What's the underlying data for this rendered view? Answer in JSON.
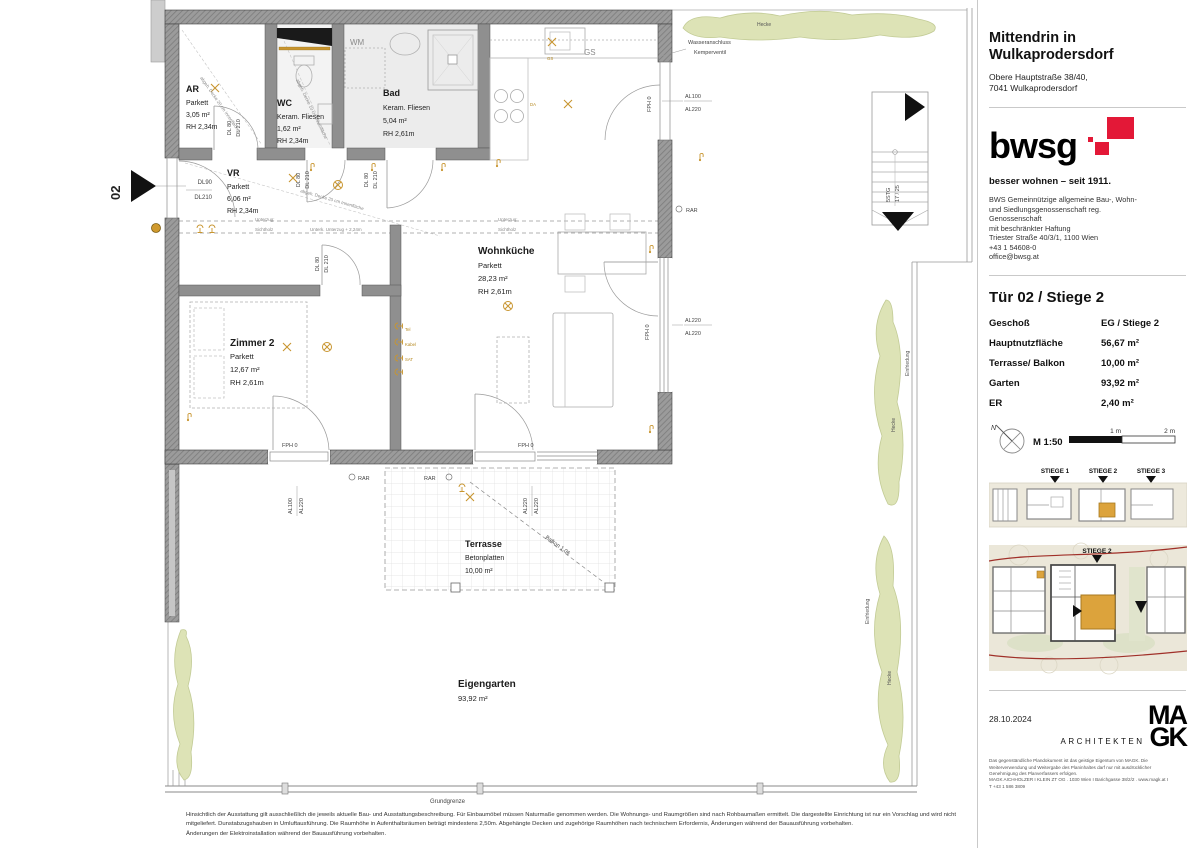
{
  "plan": {
    "rooms": {
      "ar": {
        "name": "AR",
        "mat": "Parkett",
        "area": "3,05 m²",
        "rh": "RH 2,34m"
      },
      "wc": {
        "name": "WC",
        "mat": "Keram. Fliesen",
        "area": "1,62 m²",
        "rh": "RH 2,34m"
      },
      "bad": {
        "name": "Bad",
        "mat": "Keram. Fliesen",
        "area": "5,04 m²",
        "rh": "RH 2,61m"
      },
      "vr": {
        "name": "VR",
        "mat": "Parkett",
        "area": "6,06 m²",
        "rh": "RH 2,34m"
      },
      "wohnkueche": {
        "name": "Wohnküche",
        "mat": "Parkett",
        "area": "28,23 m²",
        "rh": "RH 2,61m"
      },
      "zimmer2": {
        "name": "Zimmer 2",
        "mat": "Parkett",
        "area": "12,67 m²",
        "rh": "RH 2,61m"
      },
      "terrasse": {
        "name": "Terrasse",
        "mat": "Betonplatten",
        "area": "10,00 m²"
      },
      "eigengarten": {
        "name": "Eigengarten",
        "area": "93,92 m²"
      }
    },
    "labels": {
      "unit_number": "02",
      "dl90": "DL90",
      "dl210": "DL210",
      "dl80": "DL 80",
      "dl210s": "DL 210",
      "fph0": "FPH 0",
      "rar": "RAR",
      "al100": "AL100",
      "al220": "AL220",
      "hecke": "Hecke",
      "einfriedung": "Einfriedung",
      "grundgrenze": "Grundgrenze",
      "wm": "WM",
      "gs": "GS",
      "da": "DA",
      "wasseranschluss_l1": "Wasseranschluss",
      "wasseranschluss_l2": "Kemperventil",
      "unterzug_l1": "Unterzug:",
      "unterzug_l2": "Sichtholz",
      "unterzug_beam": "Unterk. Unterzug + 2,24m",
      "balkon": "Balkon 1.06",
      "stairs_l1": "5STG",
      "stairs_l2": "17 / 25",
      "ceiling_ar": "abgeh. Decke 20 cm Innenfläche",
      "ceiling_wc": "abgeh. Decke 10 cm Innenfläche",
      "ceiling_vr": "abgeh. Decke 20 cm Innenfläche",
      "tel": "Tel",
      "kabel": "Kabel",
      "sat": "SAT"
    }
  },
  "sidebar": {
    "project": {
      "title_l1": "Mittendrin in",
      "title_l2": "Wulkaprodersdorf",
      "address_l1": "Obere Hauptstraße 38/40,",
      "address_l2": "7041 Wulkaprodersdorf"
    },
    "bwsg": {
      "wordmark": "bwsg",
      "tagline": "besser wohnen – seit 1911.",
      "brand_color": "#e31837",
      "company_lines": [
        "BWS Gemeinnützige allgemeine Bau-, Wohn-",
        "und Siedlungsgenossenschaft reg.",
        "Genossenschaft",
        "mit beschränkter Haftung",
        "Triester Straße 40/3/1, 1100 Wien",
        "+43 1 54608-0",
        "office@bwsg.at"
      ]
    },
    "unit": {
      "title": "Tür 02 / Stiege 2",
      "rows": [
        {
          "label": "Geschoß",
          "value": "EG / Stiege 2"
        },
        {
          "label": "Hauptnutzfläche",
          "value": "56,67 m²"
        },
        {
          "label": "Terrasse/ Balkon",
          "value": "10,00 m²"
        },
        {
          "label": "Garten",
          "value": "93,92 m²"
        },
        {
          "label": "ER",
          "value": "2,40 m²"
        }
      ]
    },
    "scalebar": {
      "north": "N",
      "scale": "M 1:50",
      "tick_1": "1 m",
      "tick_2": "2 m"
    },
    "overview": {
      "stiege_1": "STIEGE 1",
      "stiege_2": "STIEGE 2",
      "stiege_3": "STIEGE 3",
      "highlight_color": "#dca33c"
    },
    "siteplan": {
      "label": "STIEGE 2"
    },
    "date": "28.10.2024",
    "architects": {
      "name_prefix": "ARCHITEKTEN",
      "logo_l1": "MA",
      "logo_l2": "GK",
      "copyright_lines": [
        "Das gegenständliche Plandokument ist das geistige Eigentum von MAGK. Die",
        "Weiterverwendung und Weitergabe des Planinhaltes darf nur mit ausdrücklicher",
        "Genehmigung des Planverfassers erfolgen.",
        "MAGK AICHHOLZER I KLEIN ZT OG . 1030 Wien I Barichgasse 38/2/2 . www.magk.at I",
        "T +43 1 586 3809"
      ]
    }
  },
  "footer": {
    "disclaimer_lines": [
      "Hinsichtlich der Ausstattung gilt ausschließlich die jeweils aktuelle Bau- und Ausstattungsbeschreibung. Für Einbaumöbel müssen Naturmaße genommen werden. Die Wohnungs- und Raumgrößen sind nach Rohbaumaßen ermittelt. Die dargestellte Einrichtung ist nur ein Vorschlag und wird nicht",
      "mitgeliefert. Dunstabzugshauben in Umluftausführung. Die Raumhöhe in Aufenthaltsräumen beträgt mindestens 2,50m. Abgehängte Decken und zugehörige Raumhöhen nach technischem Erfordernis, Änderungen während der Bauausführung vorbehalten.",
      "Änderungen der Elektroinstallation während der Bauausführung vorbehalten."
    ]
  }
}
